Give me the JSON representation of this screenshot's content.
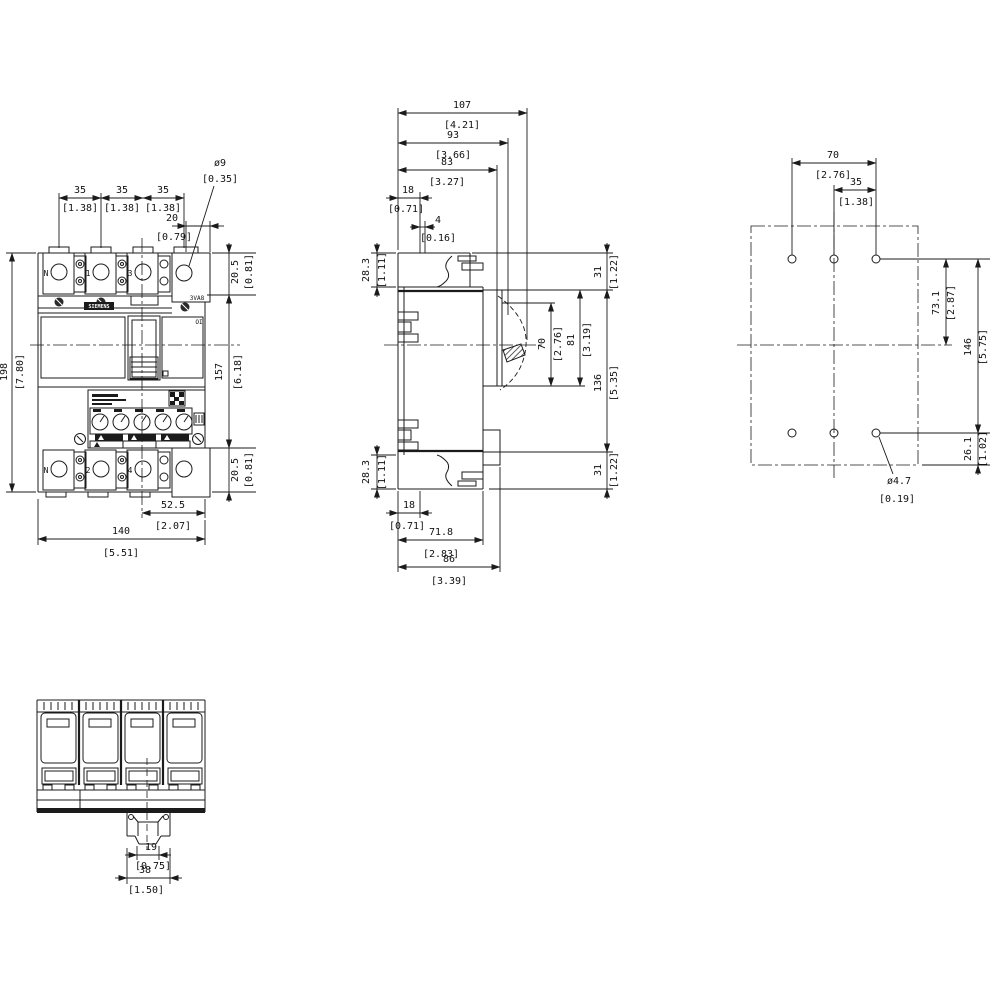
{
  "front_view": {
    "brand": "SIEMENS",
    "model": "3VA8",
    "switch_marking": "OI",
    "terminals_top": [
      "N",
      "1",
      "3"
    ],
    "terminals_bottom": [
      "N",
      "2",
      "4"
    ],
    "dims": {
      "pole_pitch_1": {
        "mm": "35",
        "in": "[1.38]"
      },
      "pole_pitch_2": {
        "mm": "35",
        "in": "[1.38]"
      },
      "pole_pitch_3": {
        "mm": "35",
        "in": "[1.38]"
      },
      "terminal_hole_dia": {
        "mm": "ø9",
        "in": "[0.35]"
      },
      "terminal_width": {
        "mm": "20",
        "in": "[0.79]"
      },
      "terminal_height_top": {
        "mm": "20.5",
        "in": "[0.81]"
      },
      "total_height": {
        "mm": "198",
        "in": "[7.80]"
      },
      "body_height": {
        "mm": "157",
        "in": "[6.18]"
      },
      "terminal_height_bottom": {
        "mm": "20.5",
        "in": "[0.81]"
      },
      "center_to_edge": {
        "mm": "52.5",
        "in": "[2.07]"
      },
      "total_width": {
        "mm": "140",
        "in": "[5.51]"
      }
    }
  },
  "side_view": {
    "dims": {
      "depth_max": {
        "mm": "107",
        "in": "[4.21]"
      },
      "depth_93": {
        "mm": "93",
        "in": "[3.66]"
      },
      "depth_83": {
        "mm": "83",
        "in": "[3.27]"
      },
      "offset_18_top": {
        "mm": "18",
        "in": "[0.71]"
      },
      "offset_4": {
        "mm": "4",
        "in": "[0.16]"
      },
      "lug_depth_top": {
        "mm": "28.3",
        "in": "[1.11]"
      },
      "edge_31_top": {
        "mm": "31",
        "in": "[1.22]"
      },
      "handle_window_70": {
        "mm": "70",
        "in": "[2.76]"
      },
      "handle_window_81": {
        "mm": "81",
        "in": "[3.19]"
      },
      "front_height_136": {
        "mm": "136",
        "in": "[5.35]"
      },
      "edge_31_bottom": {
        "mm": "31",
        "in": "[1.22]"
      },
      "lug_depth_bottom": {
        "mm": "28.3",
        "in": "[1.11]"
      },
      "offset_18_bottom": {
        "mm": "18",
        "in": "[0.71]"
      },
      "depth_case_71_8": {
        "mm": "71.8",
        "in": "[2.83]"
      },
      "depth_86": {
        "mm": "86",
        "in": "[3.39]"
      }
    }
  },
  "rear_view": {
    "dims": {
      "hole_span_70": {
        "mm": "70",
        "in": "[2.76]"
      },
      "hole_span_35": {
        "mm": "35",
        "in": "[1.38]"
      },
      "hole_to_center_73_1": {
        "mm": "73.1",
        "in": "[2.87]"
      },
      "hole_rows_146": {
        "mm": "146",
        "in": "[5.75]"
      },
      "hole_to_edge_26_1": {
        "mm": "26.1",
        "in": "[1.02]"
      },
      "mount_hole_dia": {
        "mm": "ø4.7",
        "in": "[0.19]"
      }
    }
  },
  "bottom_view": {
    "dims": {
      "clip_width_19": {
        "mm": "19",
        "in": "[0.75]"
      },
      "clip_width_38": {
        "mm": "38",
        "in": "[1.50]"
      }
    }
  }
}
